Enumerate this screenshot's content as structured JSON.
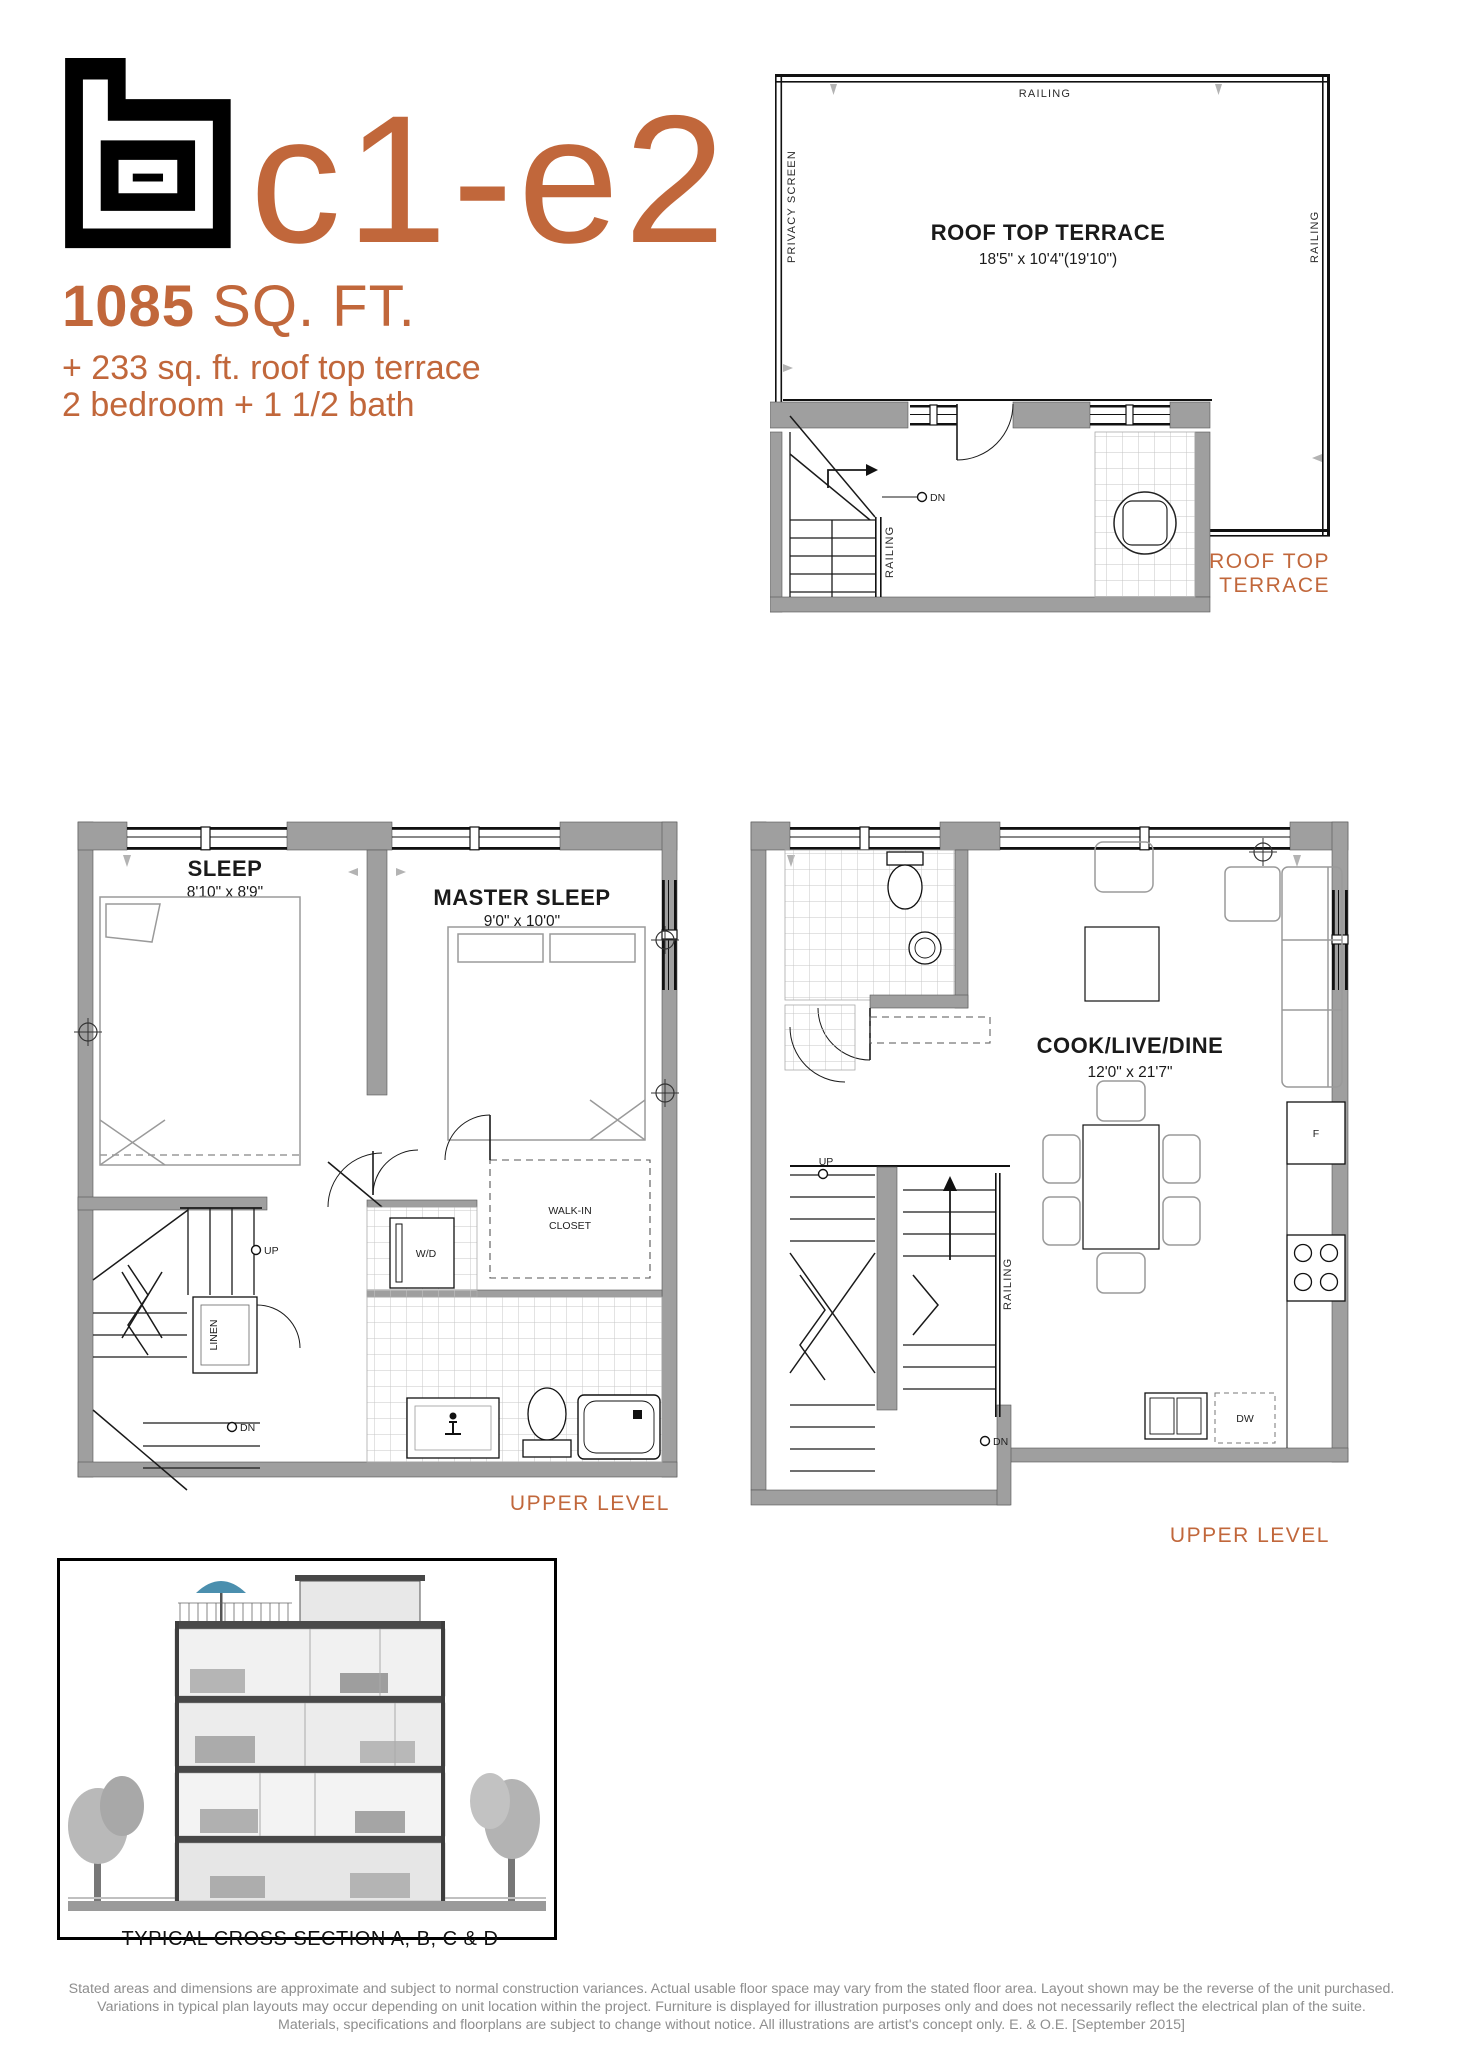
{
  "header": {
    "unit_code": "c1-e2",
    "area_value": "1085",
    "area_unit": " SQ. FT.",
    "subtitle_line1": "+ 233 sq. ft. roof top terrace",
    "subtitle_line2": "2 bedroom + 1 1/2 bath"
  },
  "roof_plan": {
    "room_name": "ROOF TOP TERRACE",
    "room_dims": "18'5\" x 10'4\"(19'10\")",
    "railing_top": "RAILING",
    "railing_right": "RAILING",
    "railing_stair": "RAILING",
    "privacy_screen": "PRIVACY SCREEN",
    "dn_label": "DN",
    "caption": "ROOF TOP TERRACE"
  },
  "bedroom_plan": {
    "sleep_name": "SLEEP",
    "sleep_dims": "8'10\" x 8'9\"",
    "master_name": "MASTER SLEEP",
    "master_dims": "9'0\" x 10'0\"",
    "wd_label": "W/D",
    "walkin_line1": "WALK-IN",
    "walkin_line2": "CLOSET",
    "linen_label": "LINEN",
    "up_label": "UP",
    "dn_label": "DN",
    "caption": "UPPER LEVEL"
  },
  "living_plan": {
    "room_name": "COOK/LIVE/DINE",
    "room_dims": "12'0\" x 21'7\"",
    "up_label": "UP",
    "dn_label": "DN",
    "railing_label": "RAILING",
    "fridge_label": "F",
    "dw_label": "DW",
    "caption": "UPPER LEVEL"
  },
  "cross_section": {
    "caption": "TYPICAL CROSS SECTION A, B, C & D"
  },
  "disclaimer": {
    "line1": "Stated areas and dimensions are approximate and subject to normal construction variances. Actual usable floor space may vary from the stated floor area. Layout shown may be the reverse of the unit purchased.",
    "line2": "Variations in typical plan layouts may occur depending on unit location within the project.  Furniture is displayed for illustration purposes only and does not necessarily reflect the electrical plan of the suite.",
    "line3": "Materials, specifications and floorplans are subject to change without notice. All illustrations are artist's concept only. E. & O.E. [September 2015]"
  },
  "colors": {
    "accent": "#c1673b",
    "wall_gray": "#9f9f9f",
    "ink": "#1a1a1a",
    "disclaimer_gray": "#8e8e8e"
  }
}
